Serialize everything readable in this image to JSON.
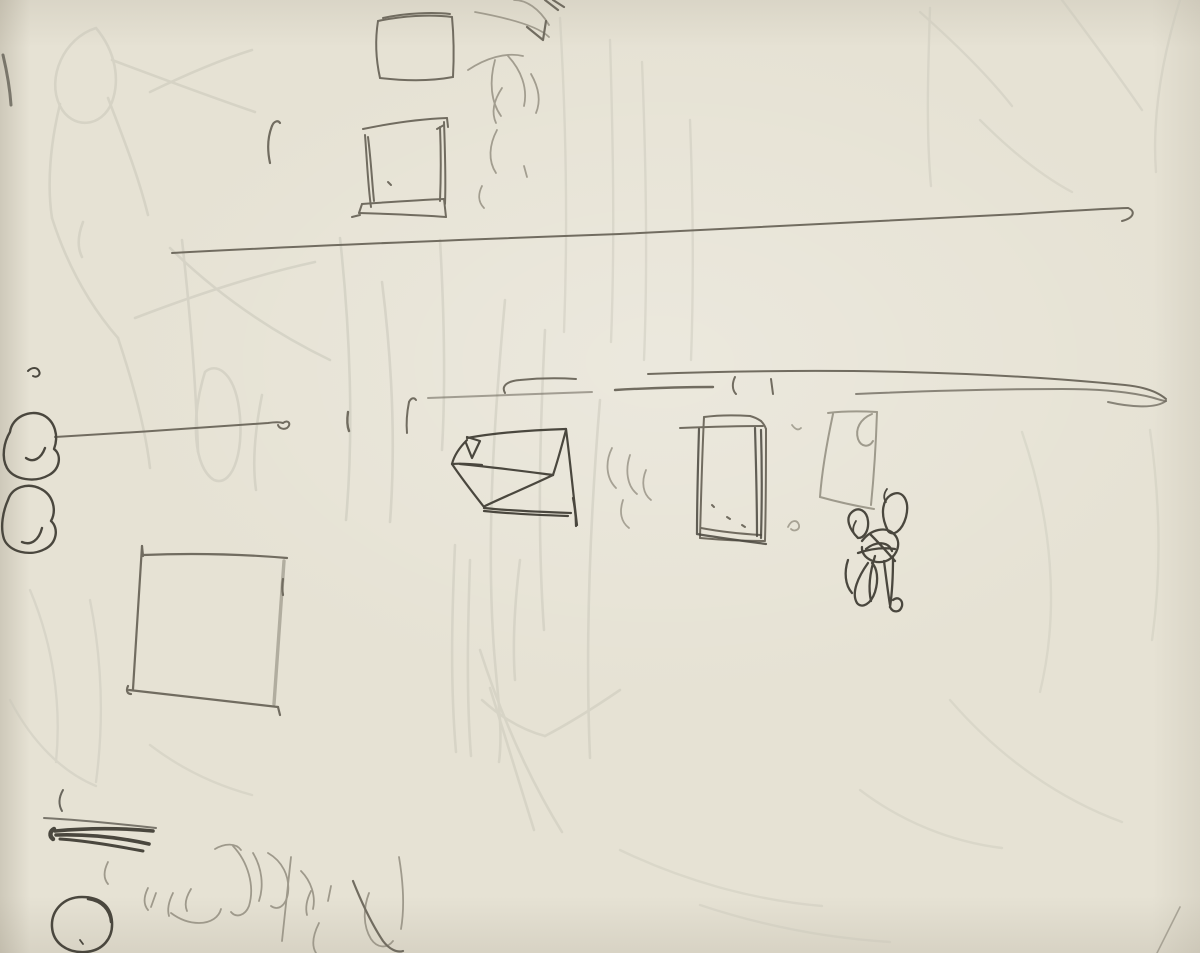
{
  "artwork": {
    "title": "Sketchbook page — faint graphite study",
    "medium": "graphite pencil on cream paper",
    "description": "A loose pencil sketch page: two small squares and a window frame at top, a long horizontal line, a second double horizontal line with tick marks, a perspective box, a tall door-like rectangle, a faint curtain rectangle, a dense scribbled figure, a large open square, two blob circles at left, dark hatch strokes, a circle and light curved scribbles at bottom, plus very faint ghost figure lines throughout."
  },
  "colors": {
    "paper": "#e6e2d4",
    "paper_light": "#efecdf",
    "pencil_dark": "#4a473e",
    "pencil_mid": "#716c60",
    "pencil_light": "#9b9688",
    "ghost": "#c9c7ba"
  }
}
